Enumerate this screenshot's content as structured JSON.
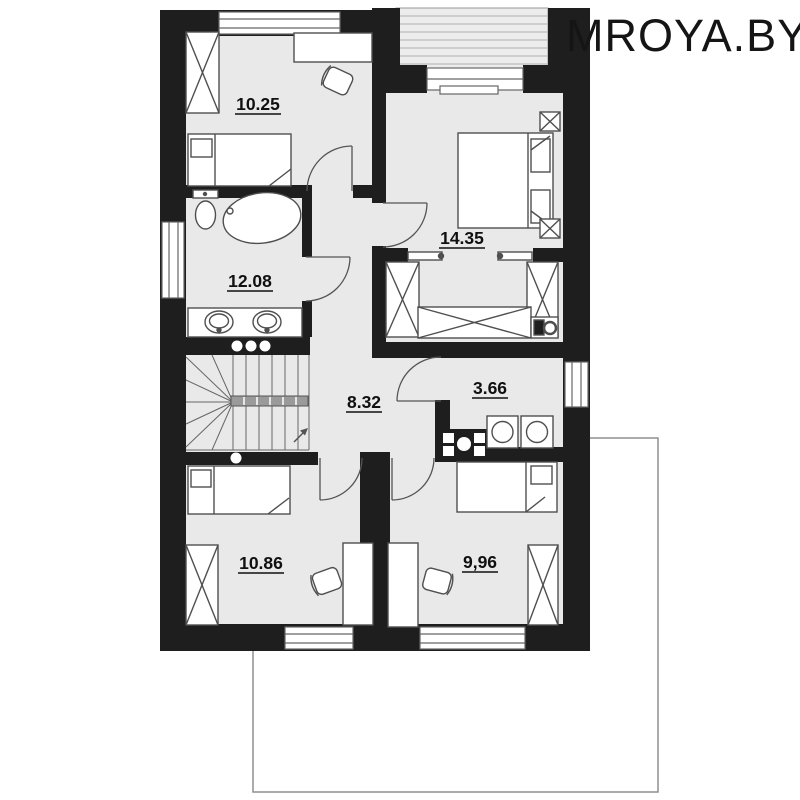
{
  "watermark": "MROYA.BY",
  "plan": {
    "type": "floor-plan",
    "rooms": [
      {
        "name": "bedroom-top-left",
        "area": "10.25"
      },
      {
        "name": "bedroom-top-right",
        "area": "14.35"
      },
      {
        "name": "bathroom",
        "area": "12.08"
      },
      {
        "name": "hallway",
        "area": "8.32"
      },
      {
        "name": "laundry",
        "area": "3.66"
      },
      {
        "name": "bedroom-bottom-left",
        "area": "10.86"
      },
      {
        "name": "bedroom-bottom-right",
        "area": "9,96"
      }
    ],
    "features": [
      "balcony-hatched-top",
      "u-shaped-staircase",
      "ground-floor-outline-bottom-right"
    ]
  },
  "colors": {
    "wall": "#1e1e1e",
    "floor": "#e9e9e9",
    "furniture_stroke": "#4f4f4f",
    "balcony_fill": "#ececec",
    "outline": "#8f8f8f",
    "label": "#101010"
  }
}
